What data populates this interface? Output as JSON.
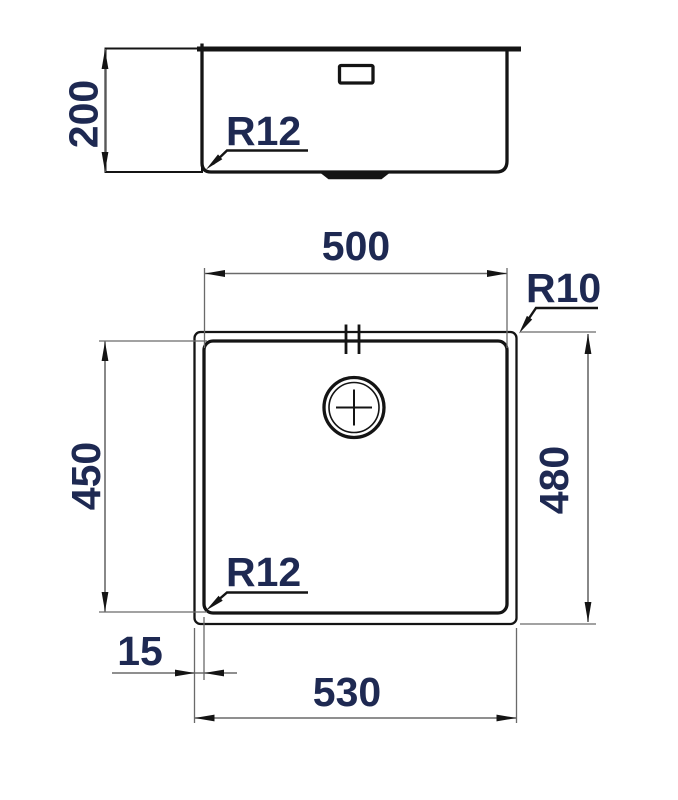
{
  "colors": {
    "line": "#141414",
    "dim": "#6a6a6a",
    "text": "#1e2952",
    "bg": "#ffffff"
  },
  "side_view": {
    "height_dim": "200",
    "corner_radius": "R12"
  },
  "plan_view": {
    "bowl_width_dim": "500",
    "bowl_height_dim": "450",
    "outer_width_dim": "530",
    "outer_height_dim": "480",
    "rim_offset_dim": "15",
    "outer_corner_radius": "R10",
    "bowl_corner_radius": "R12"
  }
}
